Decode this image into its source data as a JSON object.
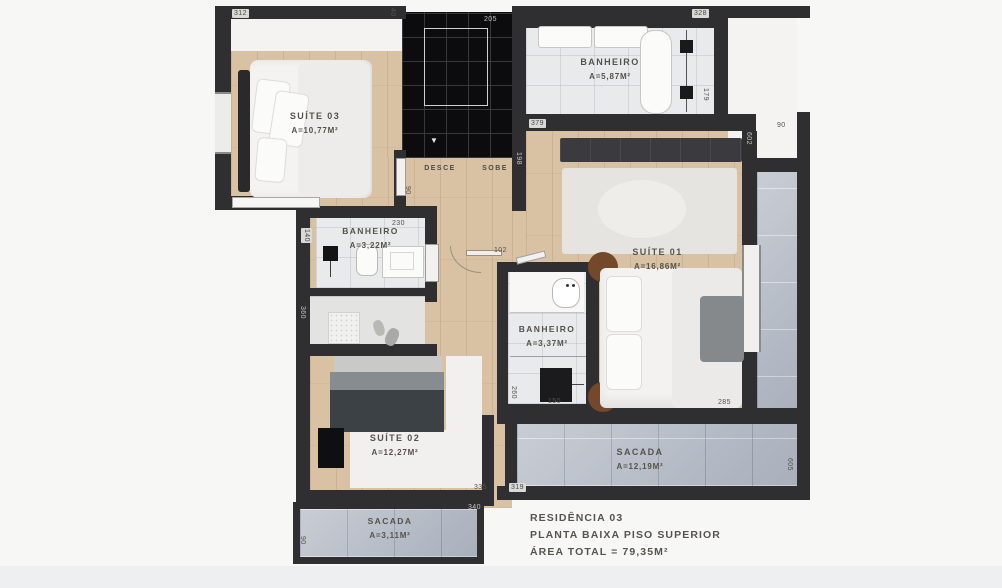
{
  "plan": {
    "type": "floor-plan",
    "wall_color": "#2f2f32",
    "wood_floor_color": "#d9c2a4",
    "bath_tile_color": "#e8eaeb",
    "balcony_tile_color": "#b6bcc7"
  },
  "rooms": [
    {
      "name": "SUÍTE 03",
      "area": "A=10,77M²"
    },
    {
      "name": "BANHEIRO",
      "area": "A=5,87M²"
    },
    {
      "name": "SUÍTE 01",
      "area": "A=16,86M²"
    },
    {
      "name": "BANHEIRO",
      "area": "A=3,22M²"
    },
    {
      "name": "BANHEIRO",
      "area": "A=3,37M²"
    },
    {
      "name": "SUÍTE 02",
      "area": "A=12,27M²"
    },
    {
      "name": "SACADA",
      "area": "A=12,19M²"
    },
    {
      "name": "SACADA",
      "area": "A=3,11M²"
    }
  ],
  "stairs": {
    "down_label": "DESCE",
    "up_label": "SOBE",
    "down_arrow": "▼"
  },
  "dims": {
    "d312": "312",
    "d40": "40",
    "d205": "205",
    "d328": "328",
    "d179": "179",
    "d90_top_right": "90",
    "d602": "602",
    "d379": "379",
    "d198": "198",
    "d90_stairs": "90",
    "d230": "230",
    "d140": "140",
    "d102": "102",
    "d360": "360",
    "d260": "260",
    "d150": "150",
    "d285": "285",
    "d335": "335",
    "d319": "319",
    "d605": "605",
    "d340": "340",
    "d90_bottom": "90"
  },
  "title_block": {
    "line1": "RESIDÊNCIA 03",
    "line2": "PLANTA BAIXA PISO SUPERIOR",
    "line3": "ÁREA TOTAL = 79,35M²"
  }
}
